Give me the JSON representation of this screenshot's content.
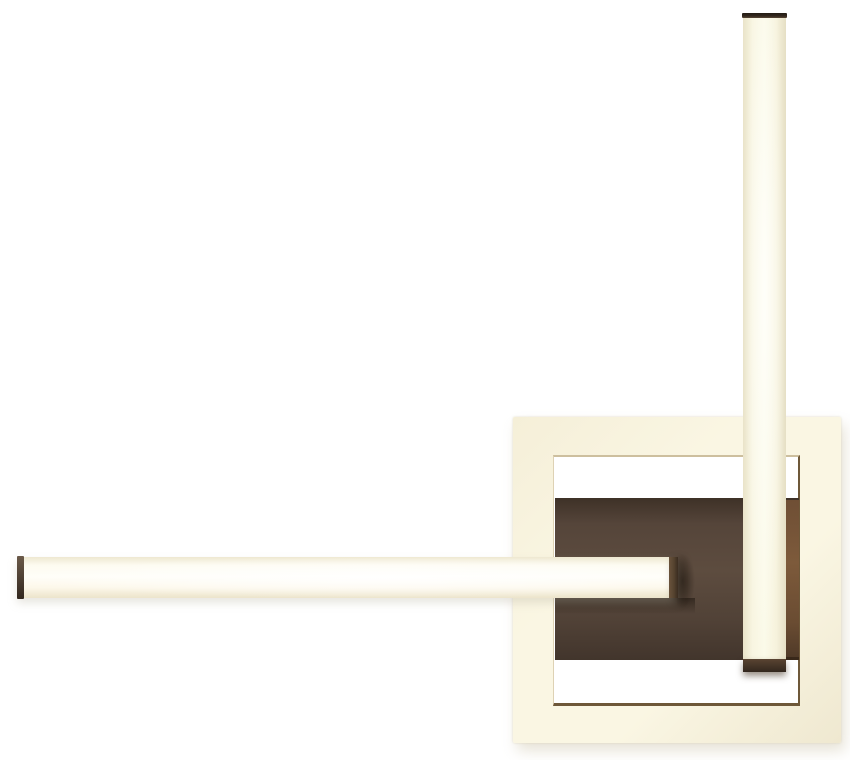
{
  "page": {
    "title": "Geometric LED ceiling light — product photo",
    "background": "#ffffff"
  },
  "product": {
    "name": "Square LED ceiling light with crossing light bars",
    "parts": {
      "frame": "Square LED frame (warm white)",
      "frame_opening": "Frame inner opening",
      "mount_plate": "Dark brown square mounting canopy",
      "mount_plate_lit_edge": "Lit right edge of mounting canopy",
      "vertical_bar": "Vertical LED light bar",
      "horizontal_bar": "Horizontal LED light bar",
      "vertical_bar_top_cap": "Dark end cap (top)",
      "vertical_bar_bottom_cap": "Dark end cap (bottom)",
      "horizontal_bar_left_cap": "Dark end cap (left)",
      "horizontal_bar_right_cap": "Dark end cap (right)"
    }
  },
  "colors": {
    "bg": "#ffffff",
    "frame_light": "#faf6e3",
    "frame_mid": "#f5efd8",
    "frame_dark_edge": "#efe8d0",
    "frame_inner_line_light": "#cdbf9e",
    "frame_inner_line_dark": "#6e5839",
    "plate_top": "#3e3127",
    "plate_mid": "#5d4c3f",
    "plate_bottom": "#42352c",
    "strip_light": "#6f4f35",
    "strip_dark": "#503a28",
    "bar_core": "#fffef8",
    "bar_cream": "#f8f5e1",
    "bar_edge": "#e9e3c9",
    "cap_dark": "#32271e",
    "cap_mid": "#55432f"
  }
}
